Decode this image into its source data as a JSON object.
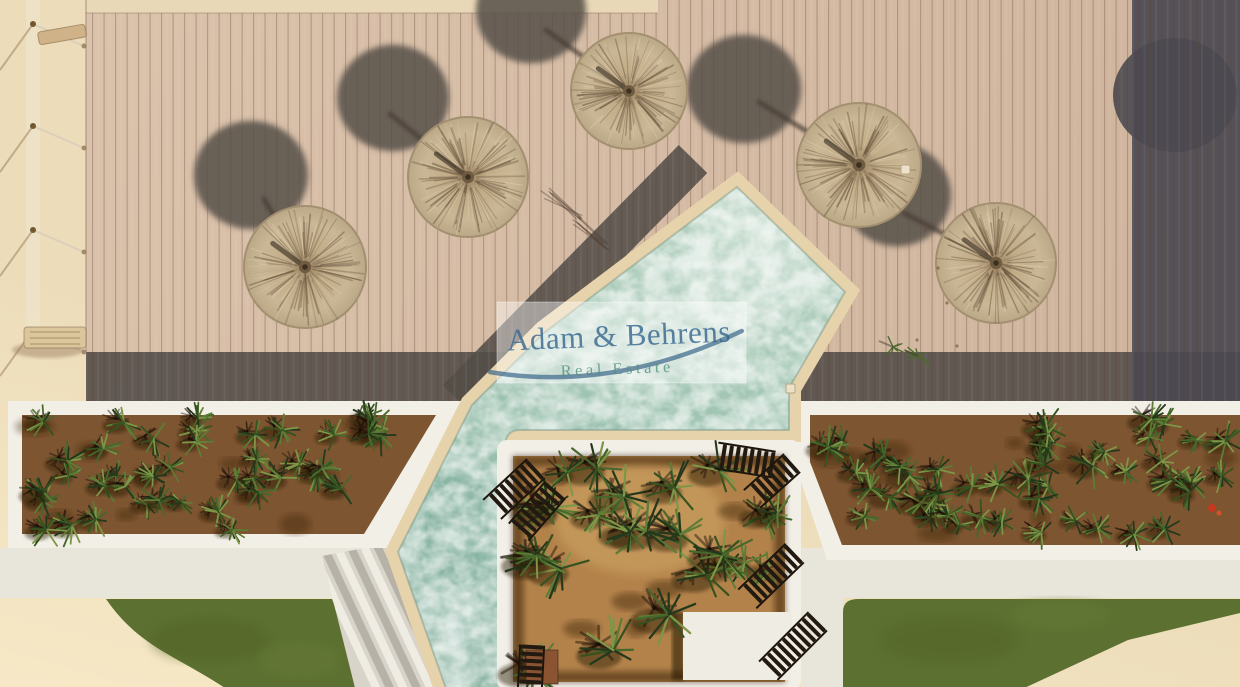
{
  "photo": {
    "kind": "aerial-photograph",
    "subject": "Drone top-down view of a resort pool area: timber sun deck with five round straw parasols casting shadows, a diagonal turquoise swimming pool with stone surround, two long white planter beds filled with agaves, a square palm courtyard with wooden sun loungers and a white platform, artificial lawns, pale sand paths and a rope fence",
    "width_px": 1240,
    "height_px": 687
  },
  "watermark": {
    "line1": "Adam & Behrens",
    "line2": "Real Estate",
    "line1_color": "#3f6d94",
    "line2_color": "#55907d",
    "swoosh_color": "#3a678a",
    "box_color": "rgba(255,255,255,0.42)"
  },
  "scene": {
    "umbrellas": 5,
    "umbrella_shadows": 5,
    "sun_loungers": 7,
    "planter_beds": 2,
    "courtyards": 1,
    "lawns": 2,
    "colors": {
      "sand": "#ecdcba",
      "deck": "#d7bda6",
      "deck_shadow": "#514c49",
      "pool_water": "#9cc2b0",
      "pool_border": "#e7d3ab",
      "planter_frame": "#f2efe7",
      "planter_soil": "#7d5530",
      "courtyard_soil": "#b2824a",
      "lawn": "#5c7031",
      "path_white": "#e8e5da",
      "umbrella_straw": "#c8b492",
      "lounger_wood": "#221a10",
      "platform": "#efece4"
    }
  }
}
